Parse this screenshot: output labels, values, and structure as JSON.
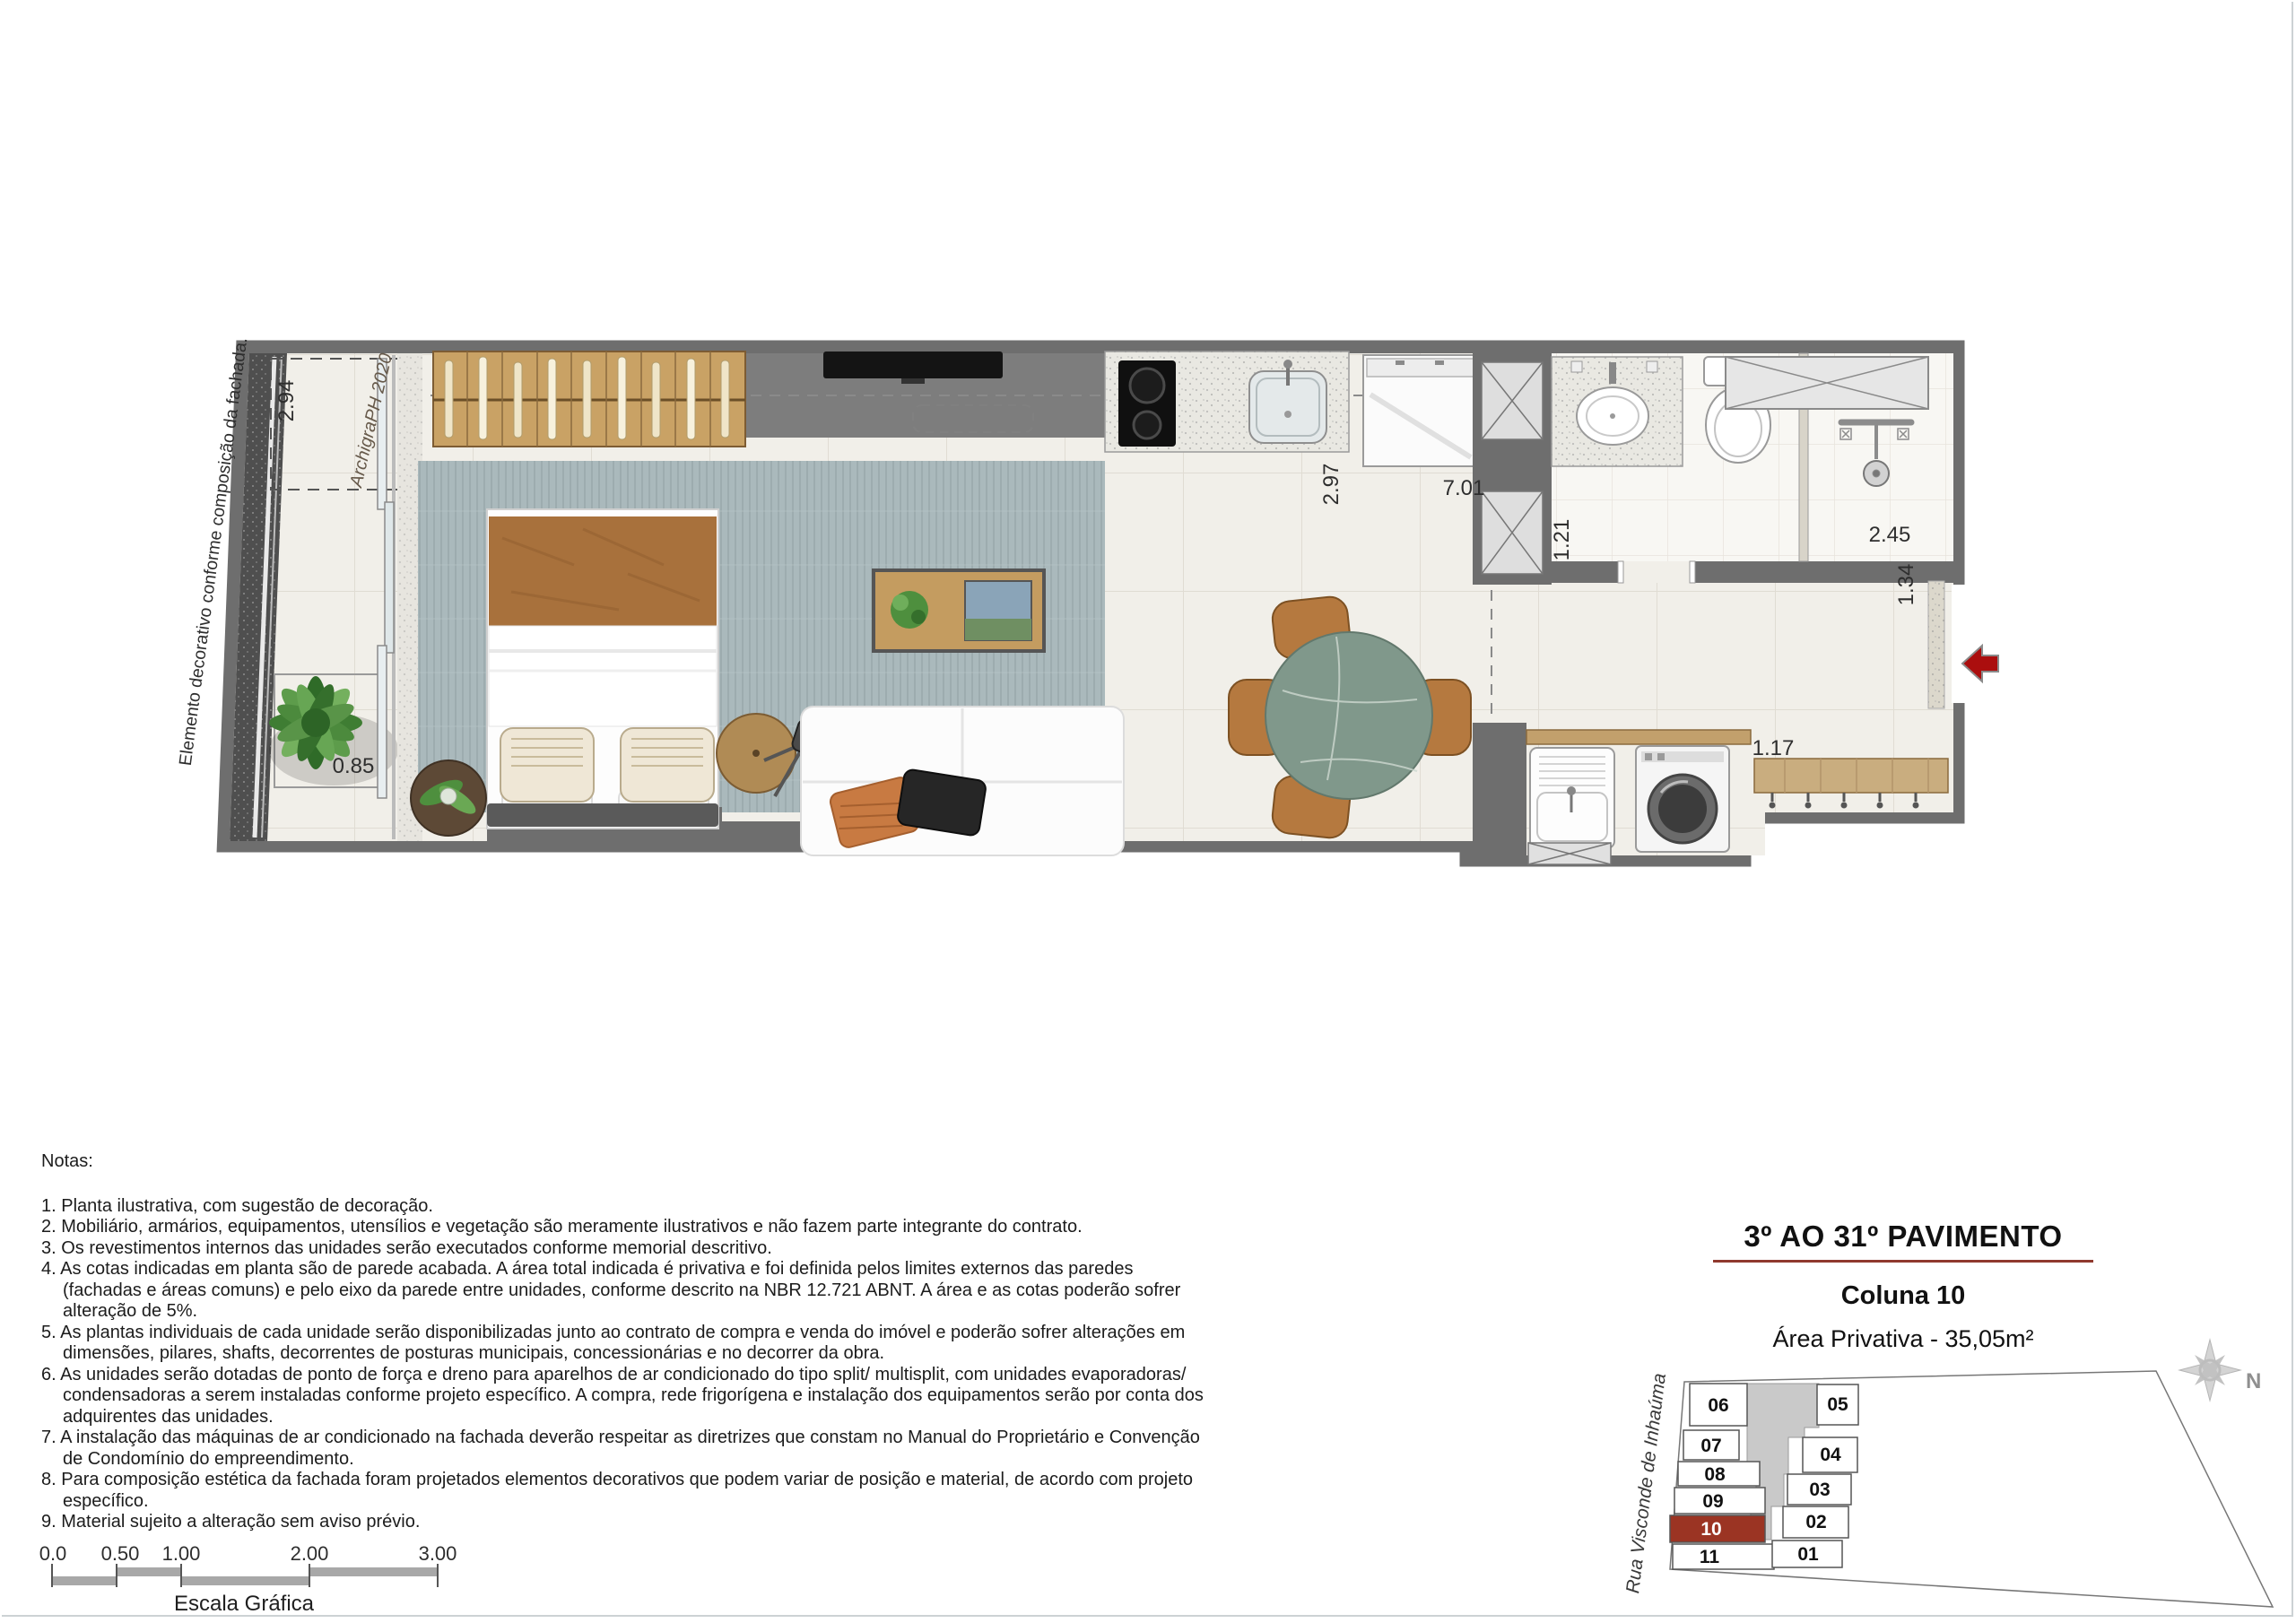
{
  "plan": {
    "facade_note": "Elemento decorativo conforme composição da fachada.",
    "signature": "ArchigraPH 2020",
    "dims": {
      "balcony_box": "2.94",
      "balcony": "0.85",
      "kitchen": "2.97",
      "length": "7.01",
      "bath": "1.21",
      "shower": "2.45",
      "hall": "1.34",
      "bench": "1.17"
    }
  },
  "notes": {
    "heading": "Notas:",
    "items": [
      "1. Planta ilustrativa, com sugestão de decoração.",
      "2. Mobiliário, armários, equipamentos, utensílios e vegetação são meramente ilustrativos e não fazem parte integrante do contrato.",
      "3. Os revestimentos internos das unidades serão executados conforme memorial descritivo.",
      "4. As cotas indicadas em planta são de parede acabada. A área total indicada é privativa e foi definida pelos limites externos das paredes (fachadas e áreas comuns) e pelo eixo da parede entre unidades, conforme descrito na NBR 12.721 ABNT. A área e as cotas poderão sofrer alteração de 5%.",
      "5. As plantas individuais de cada unidade serão disponibilizadas  junto ao contrato de compra e venda do imóvel e poderão sofrer alterações em dimensões, pilares, shafts, decorrentes de posturas municipais, concessionárias e no decorrer da obra.",
      "6. As unidades serão dotadas de ponto de força e dreno para aparelhos de ar condicionado do tipo split/ multisplit, com unidades  evaporadoras/ condensadoras a serem instaladas conforme projeto específico. A compra, rede frigorígena e instalação dos equipamentos serão por conta dos adquirentes das unidades.",
      "7. A instalação das máquinas de ar condicionado na fachada deverão respeitar as diretrizes que constam no Manual do Proprietário e Convenção de Condomínio do empreendimento.",
      "8. Para composição estética da fachada foram projetados elementos decorativos que podem variar de posição e material, de acordo com projeto específico.",
      "9. Material sujeito a alteração sem aviso prévio."
    ]
  },
  "scale_bar": {
    "labels": [
      "0.0",
      "0.50",
      "1.00",
      "2.00",
      "3.00"
    ],
    "caption": "Escala Gráfica"
  },
  "info_panel": {
    "title": "3º AO 31º PAVIMENTO",
    "subtitle": "Coluna 10",
    "area": "Área Privativa - 35,05m²"
  },
  "key_plan": {
    "street": "Rua Visconde de Inhaúma",
    "north": "N",
    "units_left": [
      "06",
      "07",
      "08",
      "09",
      "10",
      "11"
    ],
    "units_right": [
      "05",
      "04",
      "03",
      "02",
      "01"
    ],
    "highlighted_unit": "10"
  },
  "colors": {
    "accent_underline": "#8f392e",
    "unit_highlight": "#9b3423",
    "entry_arrow": "#ab0e0e",
    "wall": "#6e6e6e"
  }
}
